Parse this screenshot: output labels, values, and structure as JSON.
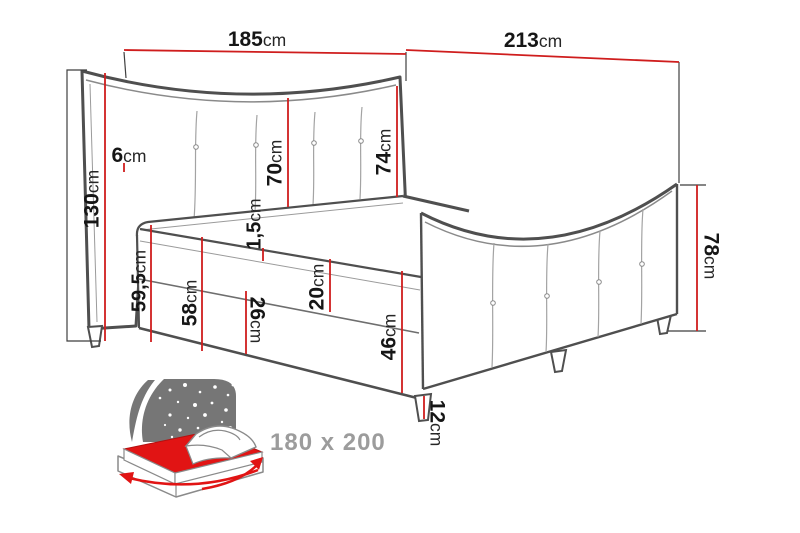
{
  "diagram": {
    "type": "bed-dimension-drawing",
    "product": "boxspring bed"
  },
  "colors": {
    "dimension_red": "#cf1d1d",
    "outline_dark": "#4f4f4f",
    "outline_light": "#9b9b9b",
    "label_text": "#161616",
    "icon_grey": "#767676",
    "icon_red": "#e11414",
    "badge_text": "#9c9c9c",
    "background": "#ffffff"
  },
  "dimensions": {
    "d185": {
      "value": "185",
      "unit": "cm",
      "orientation": "horizontal",
      "meaning": "headboard width"
    },
    "d213": {
      "value": "213",
      "unit": "cm",
      "orientation": "horizontal",
      "meaning": "total length"
    },
    "d6": {
      "value": "6",
      "unit": "cm",
      "orientation": "horizontal",
      "meaning": "headboard frame thickness"
    },
    "d130": {
      "value": "130",
      "unit": "cm",
      "orientation": "vertical-up",
      "meaning": "headboard total height"
    },
    "d70": {
      "value": "70",
      "unit": "cm",
      "orientation": "vertical-up",
      "meaning": "headboard panel height"
    },
    "d74": {
      "value": "74",
      "unit": "cm",
      "orientation": "vertical-up",
      "meaning": "headboard edge height"
    },
    "d78": {
      "value": "78",
      "unit": "cm",
      "orientation": "vertical-down",
      "meaning": "footboard height"
    },
    "d59_5": {
      "value": "59,5",
      "unit": "cm",
      "orientation": "vertical-up",
      "meaning": "floor to mattress top"
    },
    "d58": {
      "value": "58",
      "unit": "cm",
      "orientation": "vertical-up",
      "meaning": "side height"
    },
    "d26": {
      "value": "26",
      "unit": "cm",
      "orientation": "vertical-down",
      "meaning": "base box height"
    },
    "d20": {
      "value": "20",
      "unit": "cm",
      "orientation": "vertical-up",
      "meaning": "mattress height"
    },
    "d1_5": {
      "value": "1,5",
      "unit": "cm",
      "orientation": "vertical-up",
      "meaning": "topper seam"
    },
    "d46": {
      "value": "46",
      "unit": "cm",
      "orientation": "vertical-down",
      "meaning": "height to base top"
    },
    "d12": {
      "value": "12",
      "unit": "cm",
      "orientation": "vertical-down",
      "meaning": "leg height"
    }
  },
  "badge": {
    "size_label": "180 x 200",
    "icon": "mattress-size-icon"
  }
}
